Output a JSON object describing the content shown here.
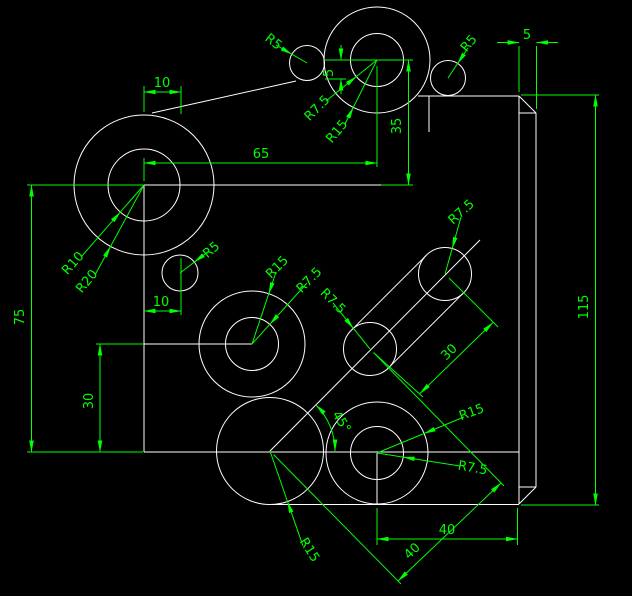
{
  "drawing": {
    "type": "CAD mechanical part drawing",
    "colors": {
      "background": "#000000",
      "geometry": "#ffffff",
      "dimension": "#00ff00"
    },
    "linear_dims": {
      "d10_top": "10",
      "d65": "65",
      "d35": "35",
      "d5_left": "5",
      "d5_bar": "5",
      "d115": "115",
      "d75": "75",
      "d30_left": "30",
      "d10_mid": "10",
      "d30_slot": "30",
      "d40_horiz": "40",
      "d40_aligned": "40",
      "d45_angle": "45°"
    },
    "radius_dims": {
      "r5_topleft": "R5",
      "r5_topright": "R5",
      "r75_top_inner": "R7.5",
      "r15_top_outer": "R15",
      "r10_left_inner": "R10",
      "r20_left_outer": "R20",
      "r5_mid": "R5",
      "r15_mid_outer": "R15",
      "r75_mid_inner": "R7.5",
      "r75_slot_lower": "R7.5",
      "r75_slot_upper": "R7.5",
      "r15_bottomright_outer": "R15",
      "r75_bottomright_inner": "R7.5",
      "r15_bottomcenter": "R15"
    }
  }
}
